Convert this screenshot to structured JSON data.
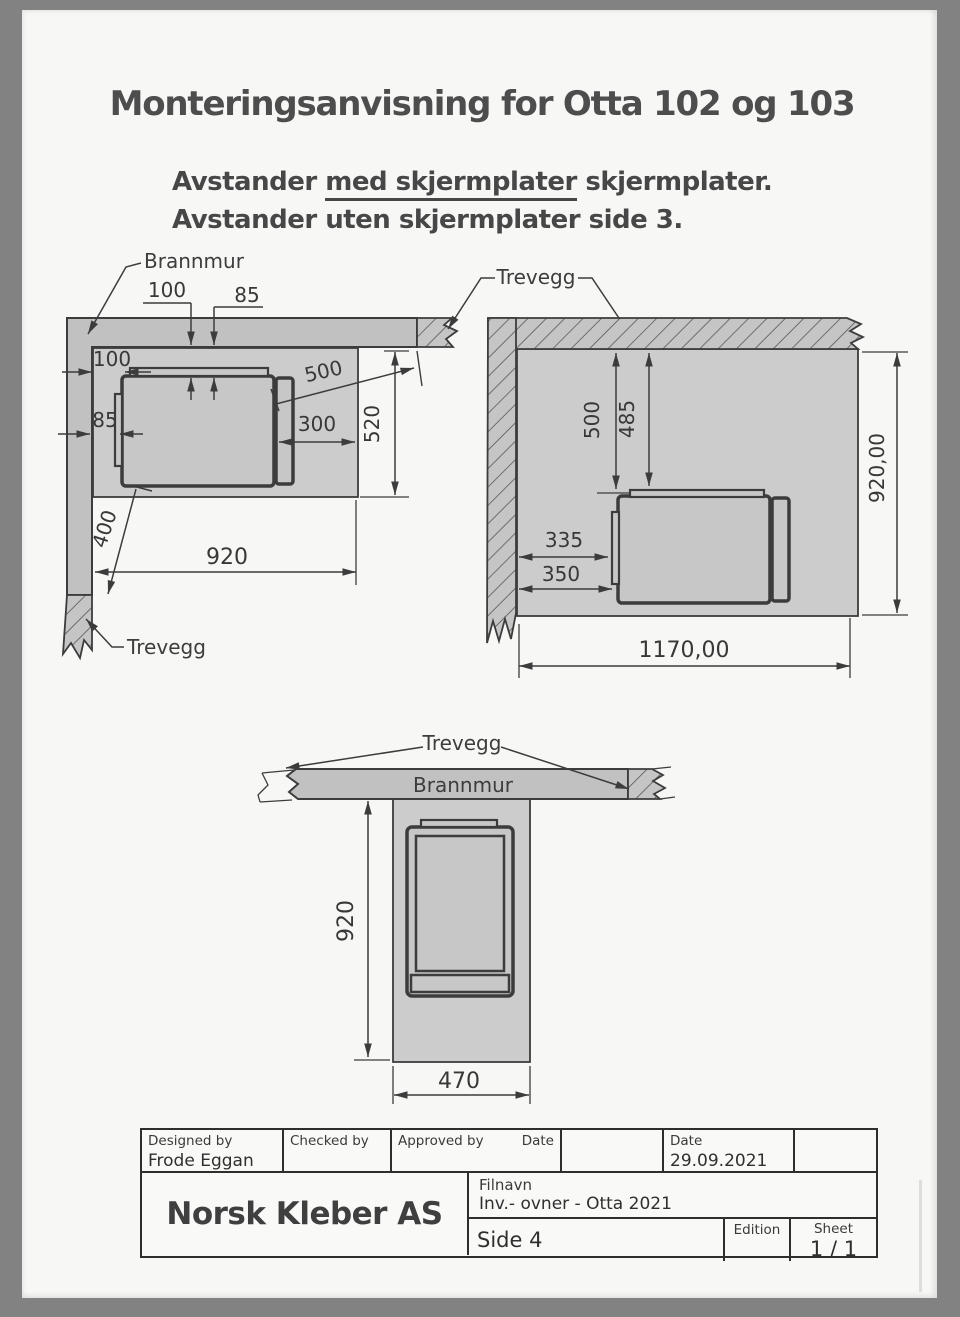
{
  "page": {
    "title": "Monteringsanvisning for Otta 102 og 103",
    "subtitle_prefix": "Avstander ",
    "subtitle_underlined": "med skjermplater",
    "subtitle_suffix": " skjermplater.",
    "subtitle_line2": "Avstander uten skjermplater side 3."
  },
  "labels": {
    "brannmur": "Brannmur",
    "trevegg": "Trevegg"
  },
  "diagram_left": {
    "gap_top_front": "100",
    "gap_top_shield": "85",
    "gap_side_front": "100",
    "gap_side_shield": "85",
    "diag_to_wall_end": "500",
    "front_to_plate_edge": "300",
    "plate_depth": "520",
    "plate_width": "920",
    "diag_to_wall_bottom": "400"
  },
  "diagram_right": {
    "gap_wall_stove": "500",
    "gap_wall_shield": "485",
    "gap_side_shield": "335",
    "gap_side_stove": "350",
    "plate_depth": "920,00",
    "plate_width": "1170,00"
  },
  "diagram_bottom": {
    "plate_length": "920",
    "plate_width": "470"
  },
  "titleblock": {
    "designed_by_label": "Designed by",
    "designed_by_value": "Frode Eggan",
    "checked_by_label": "Checked by",
    "approved_by_label": "Approved by",
    "approved_date_label": "Date",
    "date_label": "Date",
    "date_value": "29.09.2021",
    "company": "Norsk Kleber AS",
    "filename_label": "Filnavn",
    "filename_value": "Inv.- ovner - Otta 2021",
    "page_ref": "Side 4",
    "edition_label": "Edition",
    "sheet_label": "Sheet",
    "sheet_value": "1 / 1"
  }
}
